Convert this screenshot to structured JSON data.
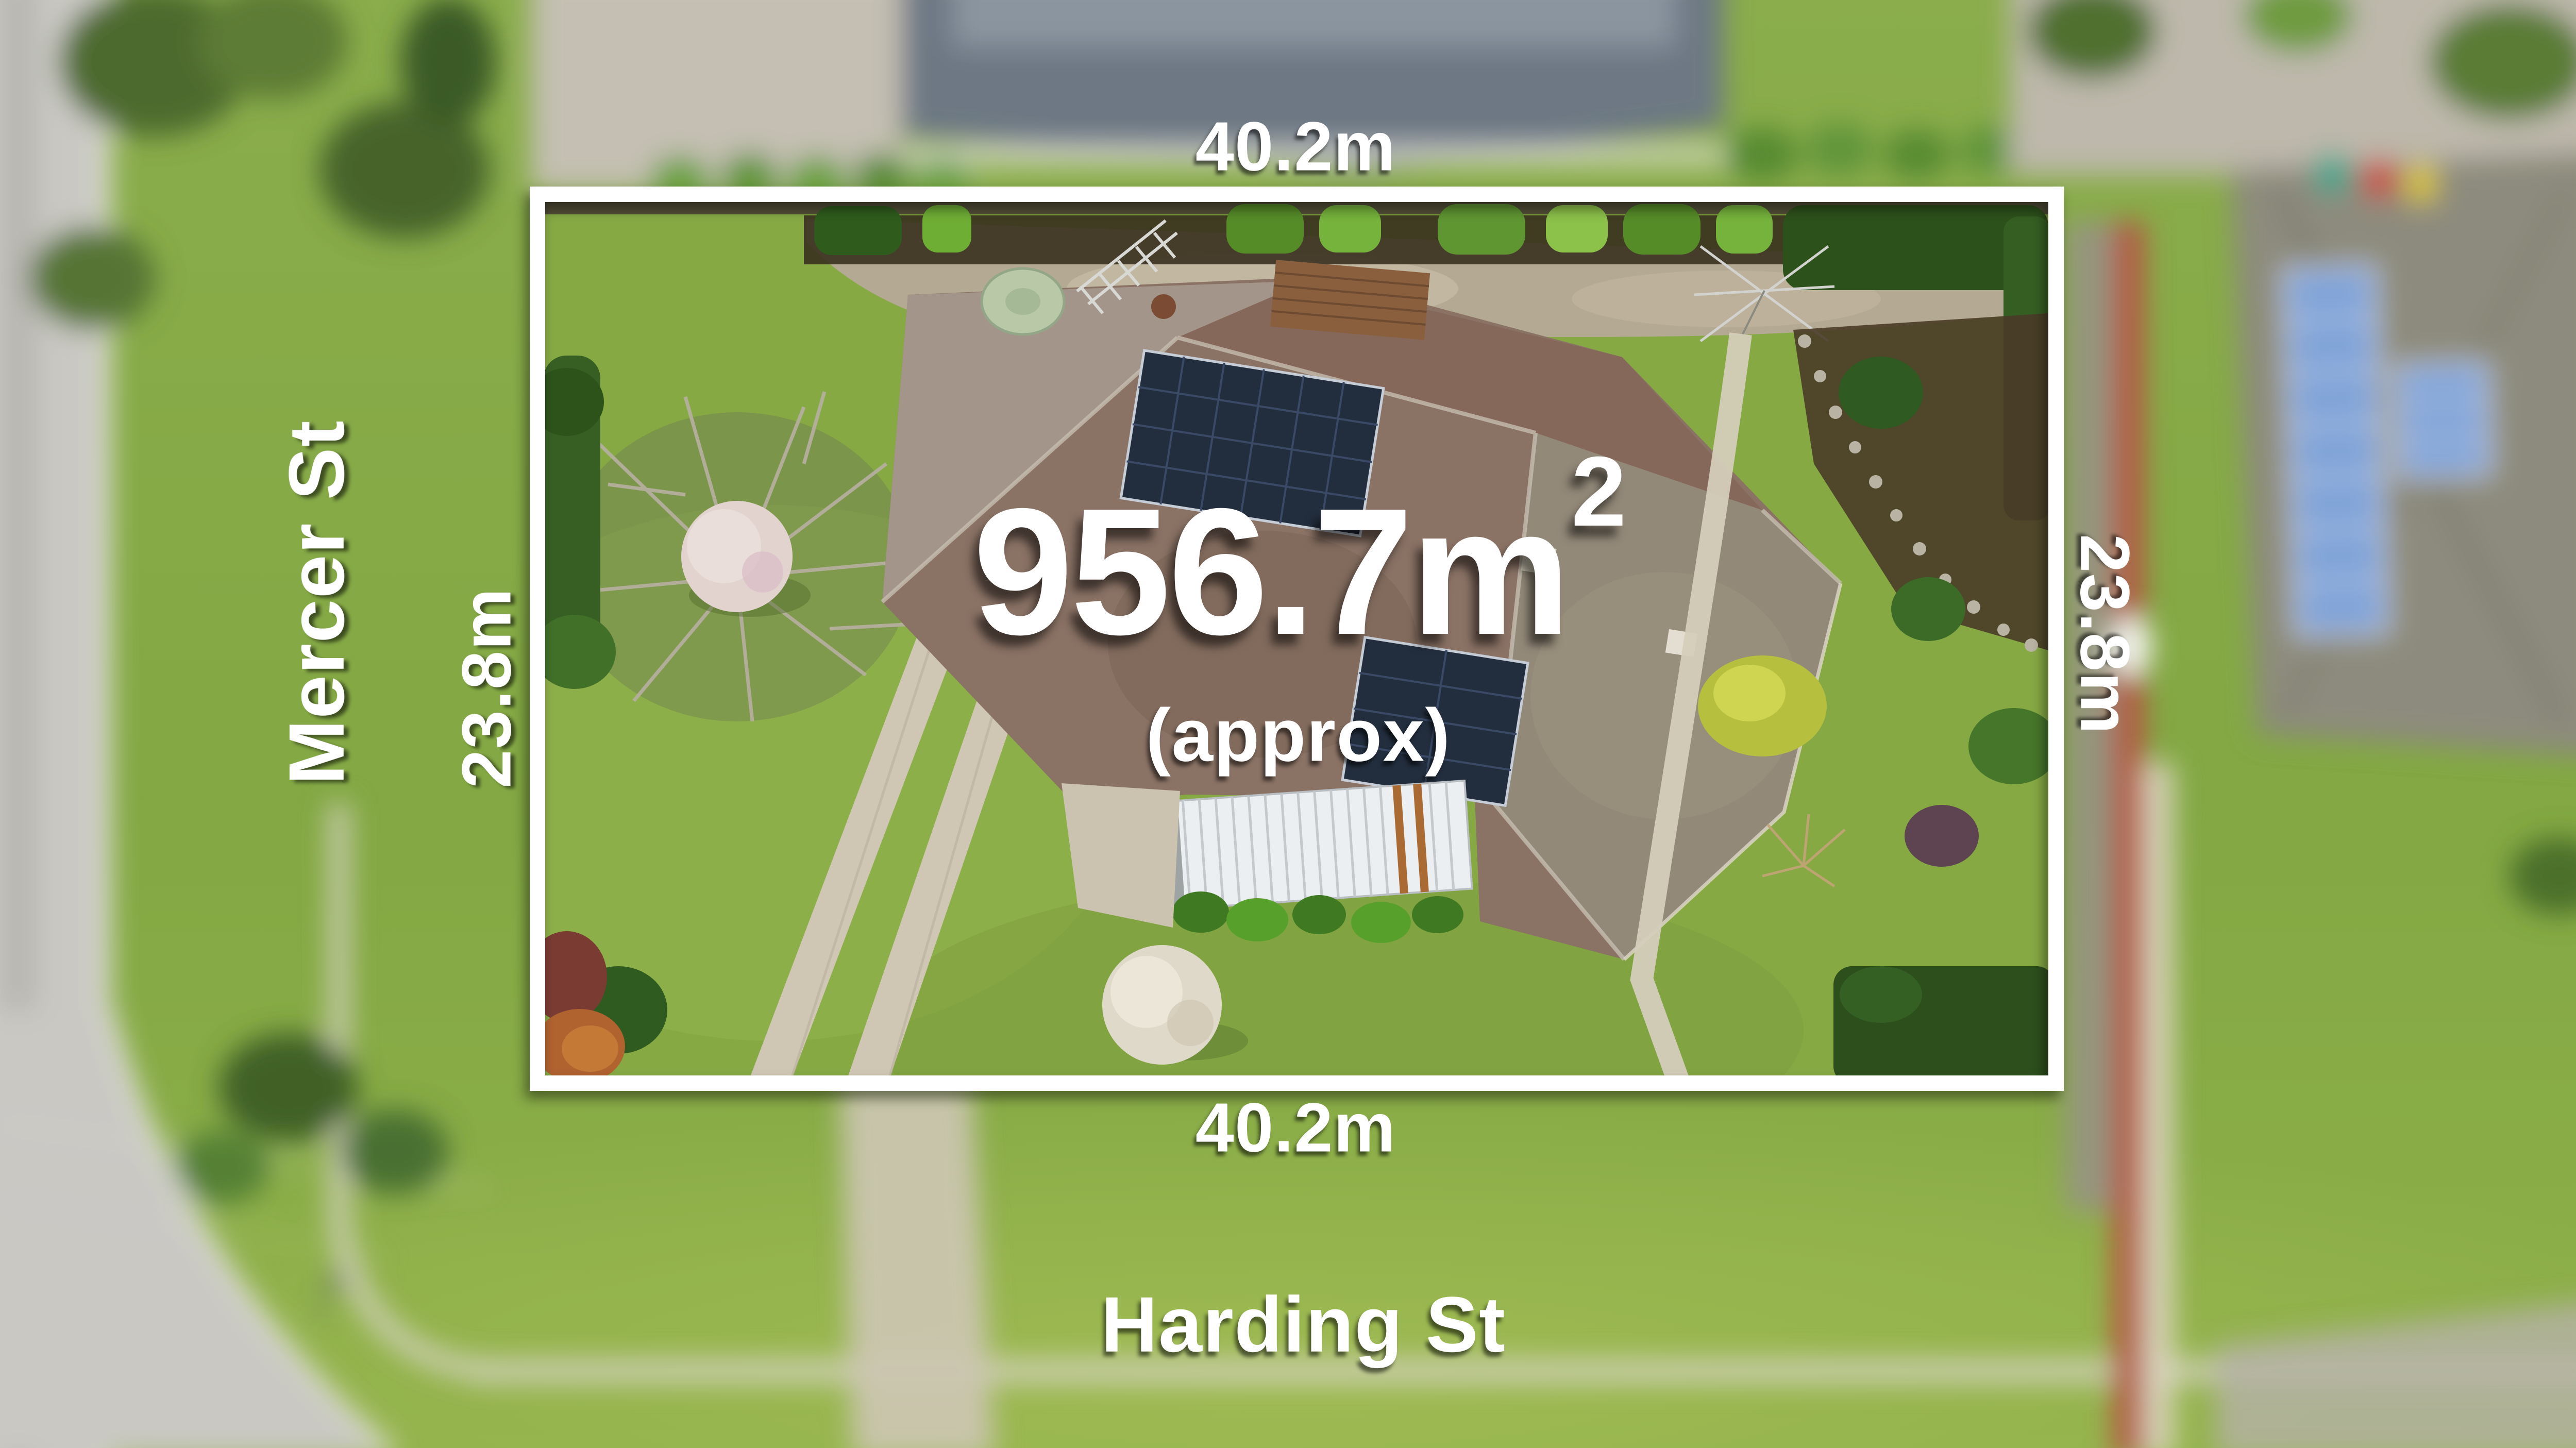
{
  "overlay": {
    "area": {
      "value": "956.7m",
      "exponent": "2",
      "qualifier": "(approx)"
    },
    "dimensions": {
      "top": "40.2m",
      "bottom": "40.2m",
      "left": "23.8m",
      "right": "23.8m"
    },
    "streets": {
      "left": "Mercer St",
      "bottom": "Harding St"
    }
  },
  "colors": {
    "boundary": "#ffffff",
    "label": "#ffffff",
    "lawn": "#84a83f",
    "roof": "#8a7265",
    "solar": "#222d3d",
    "concrete": "#b4a992",
    "road": "#c9c8c3",
    "red_path": "#b35a42",
    "pergola": "#eceff1"
  }
}
